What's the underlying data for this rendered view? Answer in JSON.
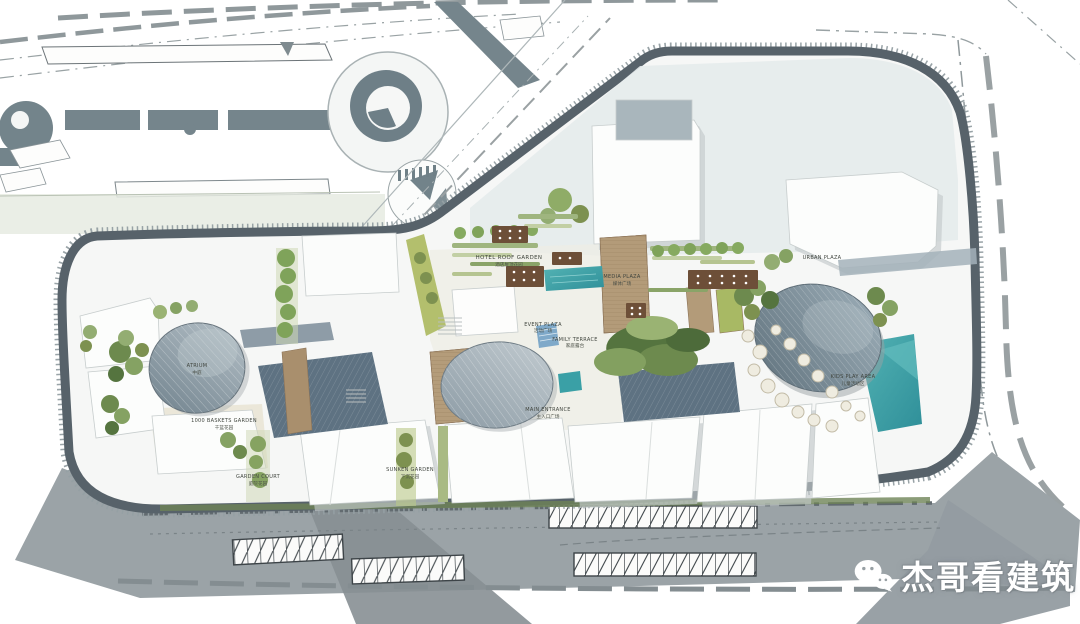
{
  "watermark": {
    "text": "杰哥看建筑",
    "icon": "wechat-logo"
  },
  "plan": {
    "labels": {
      "hotel_roof_garden": {
        "en": "HOTEL ROOF GARDEN",
        "cn": "酒店屋顶花园"
      },
      "media_plaza": {
        "en": "MEDIA PLAZA",
        "cn": "媒体广场"
      },
      "event_plaza": {
        "en": "EVENT PLAZA",
        "cn": "活动广场"
      },
      "family_terrace": {
        "en": "FAMILY TERRACE",
        "cn": "家庭露台"
      },
      "main_entrance": {
        "en": "MAIN ENTRANCE",
        "cn": "主入口广场"
      },
      "baskets_garden": {
        "en": "1000 BASKETS GARDEN",
        "cn": "千篮花园"
      },
      "atrium": {
        "en": "ATRIUM",
        "cn": "中庭"
      },
      "sunken_garden": {
        "en": "SUNKEN GARDEN",
        "cn": "下沉花园"
      },
      "green_court": {
        "en": "GARDEN COURT",
        "cn": "庭院花园"
      },
      "urban_plaza": {
        "en": "URBAN PLAZA",
        "cn": ""
      },
      "kids_play": {
        "en": "KIDS PLAY AREA",
        "cn": "儿童活动区"
      }
    },
    "colors": {
      "ring": "#57626a",
      "road": "#9ba3a7",
      "shadow": "#878f94",
      "pool": "#3aa0a6",
      "dome_dark": "#5f717c",
      "green_dark": "#55743f",
      "green_light": "#c2cfa0",
      "wood": "#b39b79",
      "paving": "#eeece4"
    }
  }
}
